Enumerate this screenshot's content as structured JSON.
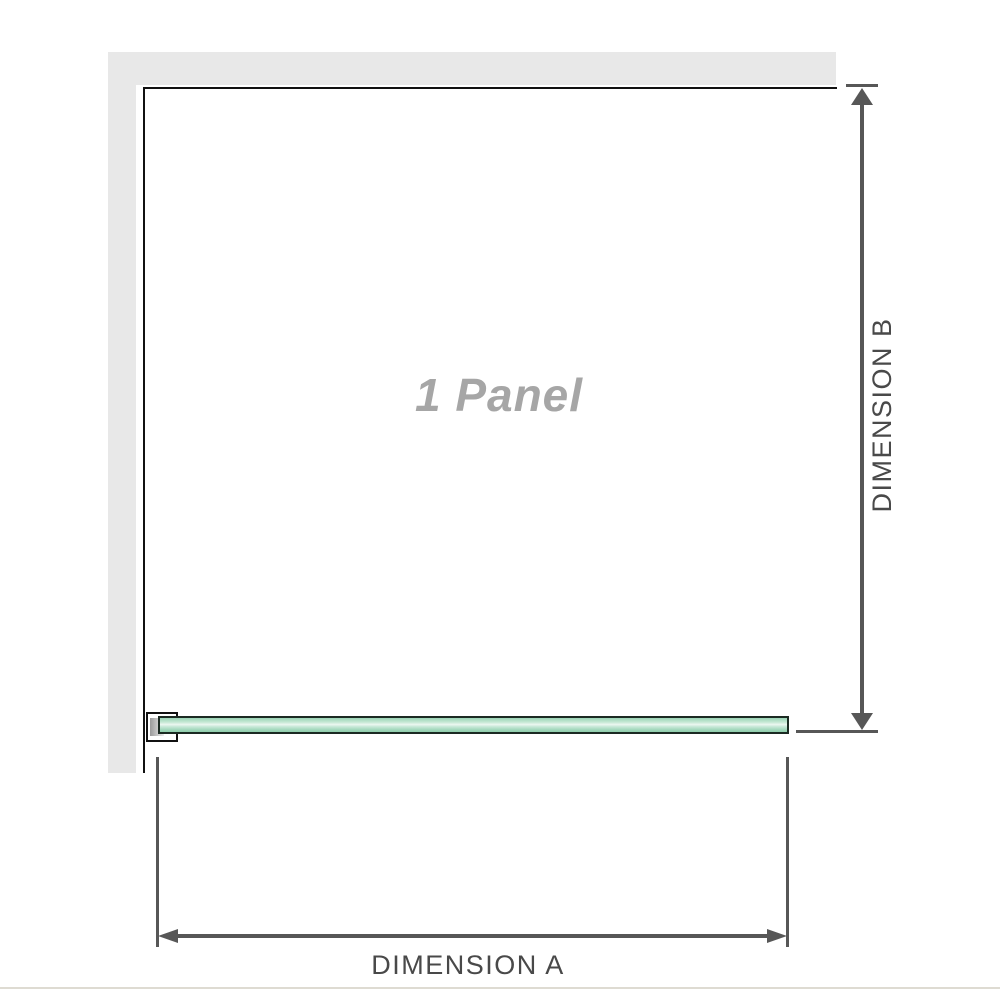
{
  "labels": {
    "panel": "1 Panel",
    "dimension_a": "DIMENSION A",
    "dimension_b": "DIMENSION B"
  },
  "colors": {
    "wall": "#e8e8e8",
    "outline": "#111111",
    "dimension": "#575757",
    "glass-border": "#1b2a22",
    "glass-top": "#9ad4b6",
    "glass-mid": "#edf7f1",
    "glass-bottom": "#8fceab",
    "panel-label": "#a6a6a6",
    "dim-label": "#494949",
    "separator": "#dedbd2"
  }
}
